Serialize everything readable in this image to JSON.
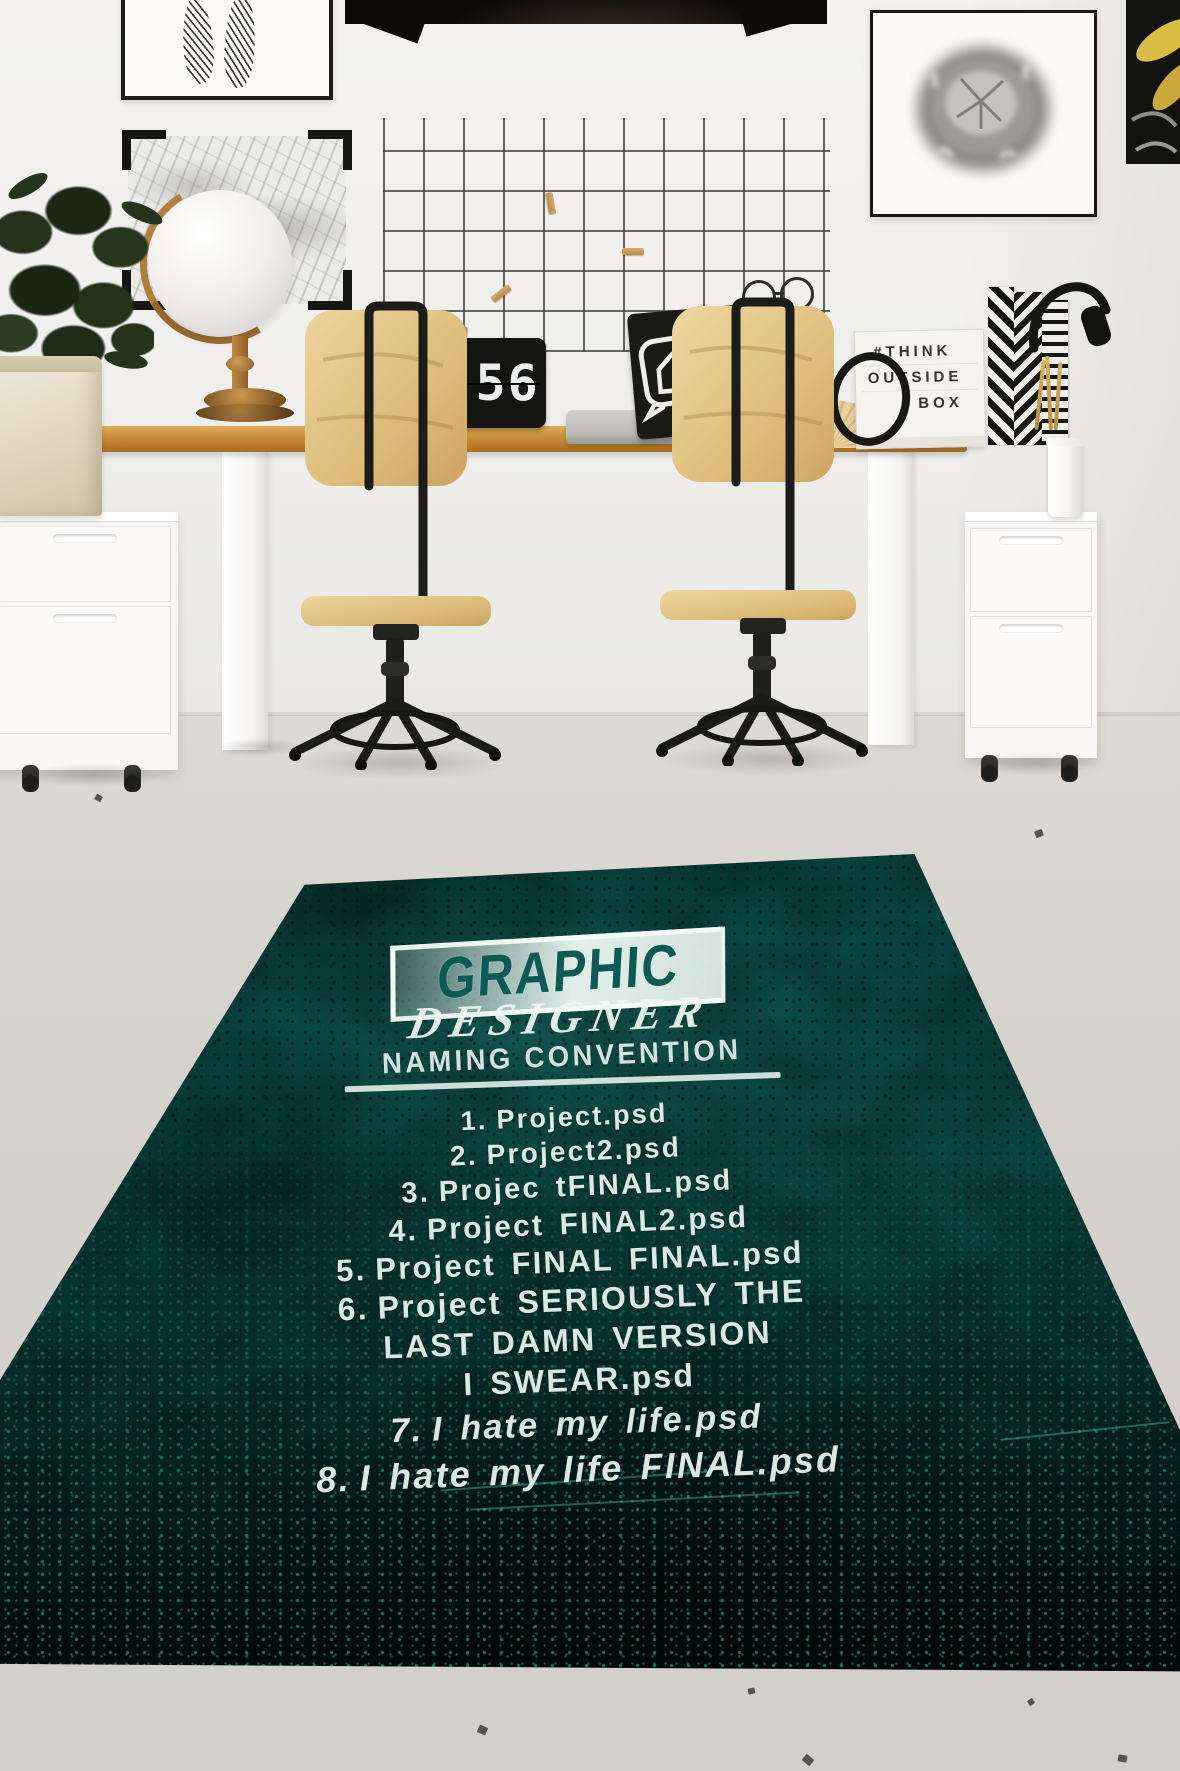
{
  "clock": {
    "hour": "9",
    "minute": "56"
  },
  "lightbox": {
    "line1": "#THINK",
    "line2": "OUTSIDE",
    "line3": "BOX"
  },
  "chalkboard": {
    "hashtag_glyph": "#"
  },
  "rug": {
    "title": "GRAPHIC",
    "subtitle": "DESIGNER",
    "heading": "NAMING CONVENTION",
    "list": [
      {
        "prefix": "1.",
        "text": "Project.psd",
        "italic": false
      },
      {
        "prefix": "2.",
        "text": "Project2.psd",
        "italic": false
      },
      {
        "prefix": "3.",
        "text": "Projec tFINAL.psd",
        "italic": false
      },
      {
        "prefix": "4.",
        "text": "Project FINAL2.psd",
        "italic": false
      },
      {
        "prefix": "5.",
        "text": "Project FINAL FINAL.psd",
        "italic": false
      },
      {
        "prefix": "6.",
        "text": "Project SERIOUSLY THE",
        "italic": false
      },
      {
        "prefix": "",
        "text": "LAST DAMN VERSION",
        "italic": false
      },
      {
        "prefix": "",
        "text": "I SWEAR.psd",
        "italic": false
      },
      {
        "prefix": "7.",
        "text": "I hate my life.psd",
        "italic": true
      },
      {
        "prefix": "8.",
        "text": "I hate my life FINAL.psd",
        "italic": true
      }
    ],
    "colors": {
      "teal_base": "#0d736b",
      "teal_bright": "#1fa193",
      "dark_edge": "#041714",
      "text": "#ecf6f1"
    }
  }
}
